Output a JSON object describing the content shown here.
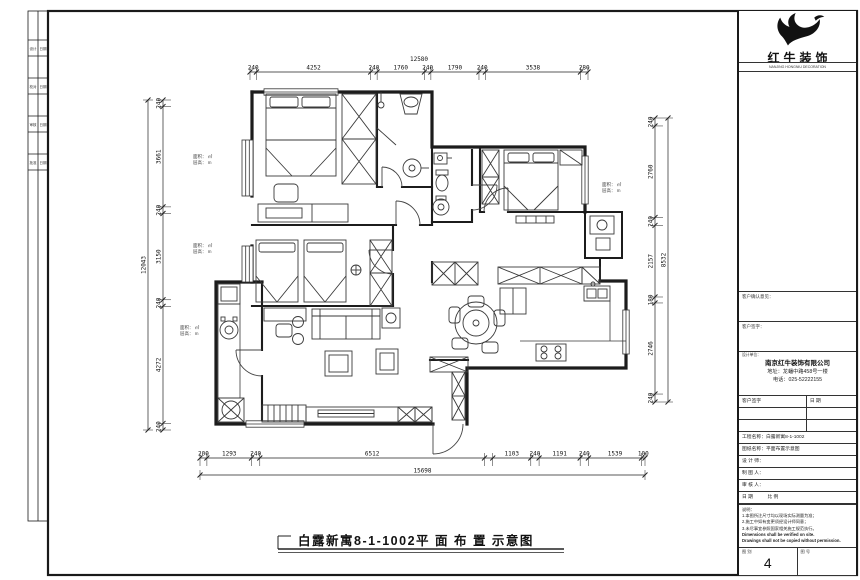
{
  "sheet": {
    "bottom_title": "白露新寓8-1-1002平 面 布 置 示意图",
    "sheet_number": "4"
  },
  "title_block": {
    "logo_text": "红牛装饰",
    "logo_sub": "NANJING HONGNIU DECORATION",
    "client_row1": "客户确认意见：",
    "client_row2": "客户签字：",
    "company": {
      "header": "设计单位：",
      "name": "南京红牛装饰有限公司",
      "address": "地址：龙蟠中路458号一楼",
      "phone": "电话：025-52222155"
    },
    "rows": [
      {
        "left": "客户签字",
        "right": "日 期"
      },
      {
        "left": "",
        "right": ""
      },
      {
        "left": "",
        "right": ""
      },
      {
        "text": "工程名称：白露新寓8-1-1002"
      },
      {
        "text": "图纸名称：平面布置示意图"
      },
      {
        "text": "设 计 师："
      },
      {
        "text": "制 图 人："
      },
      {
        "text": "审 核 人："
      },
      {
        "text": "日 期　　　比 例"
      }
    ],
    "notes": [
      "说明：",
      "1.本图所注尺寸均以现场实际测量为准；",
      "2.施工中如有变更须经设计师同意；",
      "3.未尽事宜参照国家相关施工规范执行。",
      "Dimensions shall be verified on site.",
      "Drawings shall not be copied without permission."
    ],
    "bottom_left_label": "图 别",
    "bottom_right_label": "图 号"
  },
  "margin_strip": {
    "cells": [
      {
        "l": "设计",
        "r": "日期"
      },
      {
        "l": "校对",
        "r": "日期"
      },
      {
        "l": "审核",
        "r": "日期"
      },
      {
        "l": "批准",
        "r": "日期"
      }
    ]
  },
  "dimensions": {
    "top": {
      "total": "12580",
      "segments": [
        {
          "v": 240,
          "label": "240"
        },
        {
          "v": 4252,
          "label": "4252"
        },
        {
          "v": 240,
          "label": "240"
        },
        {
          "v": 1760,
          "label": "1760"
        },
        {
          "v": 240,
          "label": "240"
        },
        {
          "v": 1790,
          "label": "1790"
        },
        {
          "v": 240,
          "label": "240"
        },
        {
          "v": 3538,
          "label": "3538"
        },
        {
          "v": 280,
          "label": "280"
        }
      ]
    },
    "left": {
      "total": "12043",
      "segments": [
        {
          "v": 240,
          "label": "240"
        },
        {
          "v": 3661,
          "label": "3661"
        },
        {
          "v": 240,
          "label": "240"
        },
        {
          "v": 3150,
          "label": "3150"
        },
        {
          "v": 240,
          "label": "240"
        },
        {
          "v": 4272,
          "label": "4272"
        },
        {
          "v": 240,
          "label": "240"
        }
      ]
    },
    "right": {
      "total": "8532",
      "segments": [
        {
          "v": 240,
          "label": "240"
        },
        {
          "v": 2760,
          "label": "2760"
        },
        {
          "v": 240,
          "label": "240"
        },
        {
          "v": 2157,
          "label": "2157"
        },
        {
          "v": 180,
          "label": "180"
        },
        {
          "v": 2746,
          "label": "2746"
        },
        {
          "v": 240,
          "label": "240"
        }
      ]
    },
    "bottom": {
      "total": "15698",
      "segments": [
        {
          "v": 200,
          "label": "200"
        },
        {
          "v": 1293,
          "label": "1293"
        },
        {
          "v": 240,
          "label": "240"
        },
        {
          "v": 6512,
          "label": "6512"
        },
        {
          "v": 240,
          "label": ""
        },
        {
          "v": 1103,
          "label": "1103"
        },
        {
          "v": 240,
          "label": "240"
        },
        {
          "v": 1191,
          "label": "1191"
        },
        {
          "v": 240,
          "label": "240"
        },
        {
          "v": 1539,
          "label": "1539"
        },
        {
          "v": 100,
          "label": "100"
        }
      ]
    }
  },
  "plan_labels": [
    {
      "a": "面积： ㎡",
      "b": "层高： m"
    },
    {
      "a": "面积： ㎡",
      "b": "层高： m"
    },
    {
      "a": "面积： ㎡",
      "b": "层高： m"
    },
    {
      "a": "面积： ㎡",
      "b": "层高： m"
    }
  ]
}
